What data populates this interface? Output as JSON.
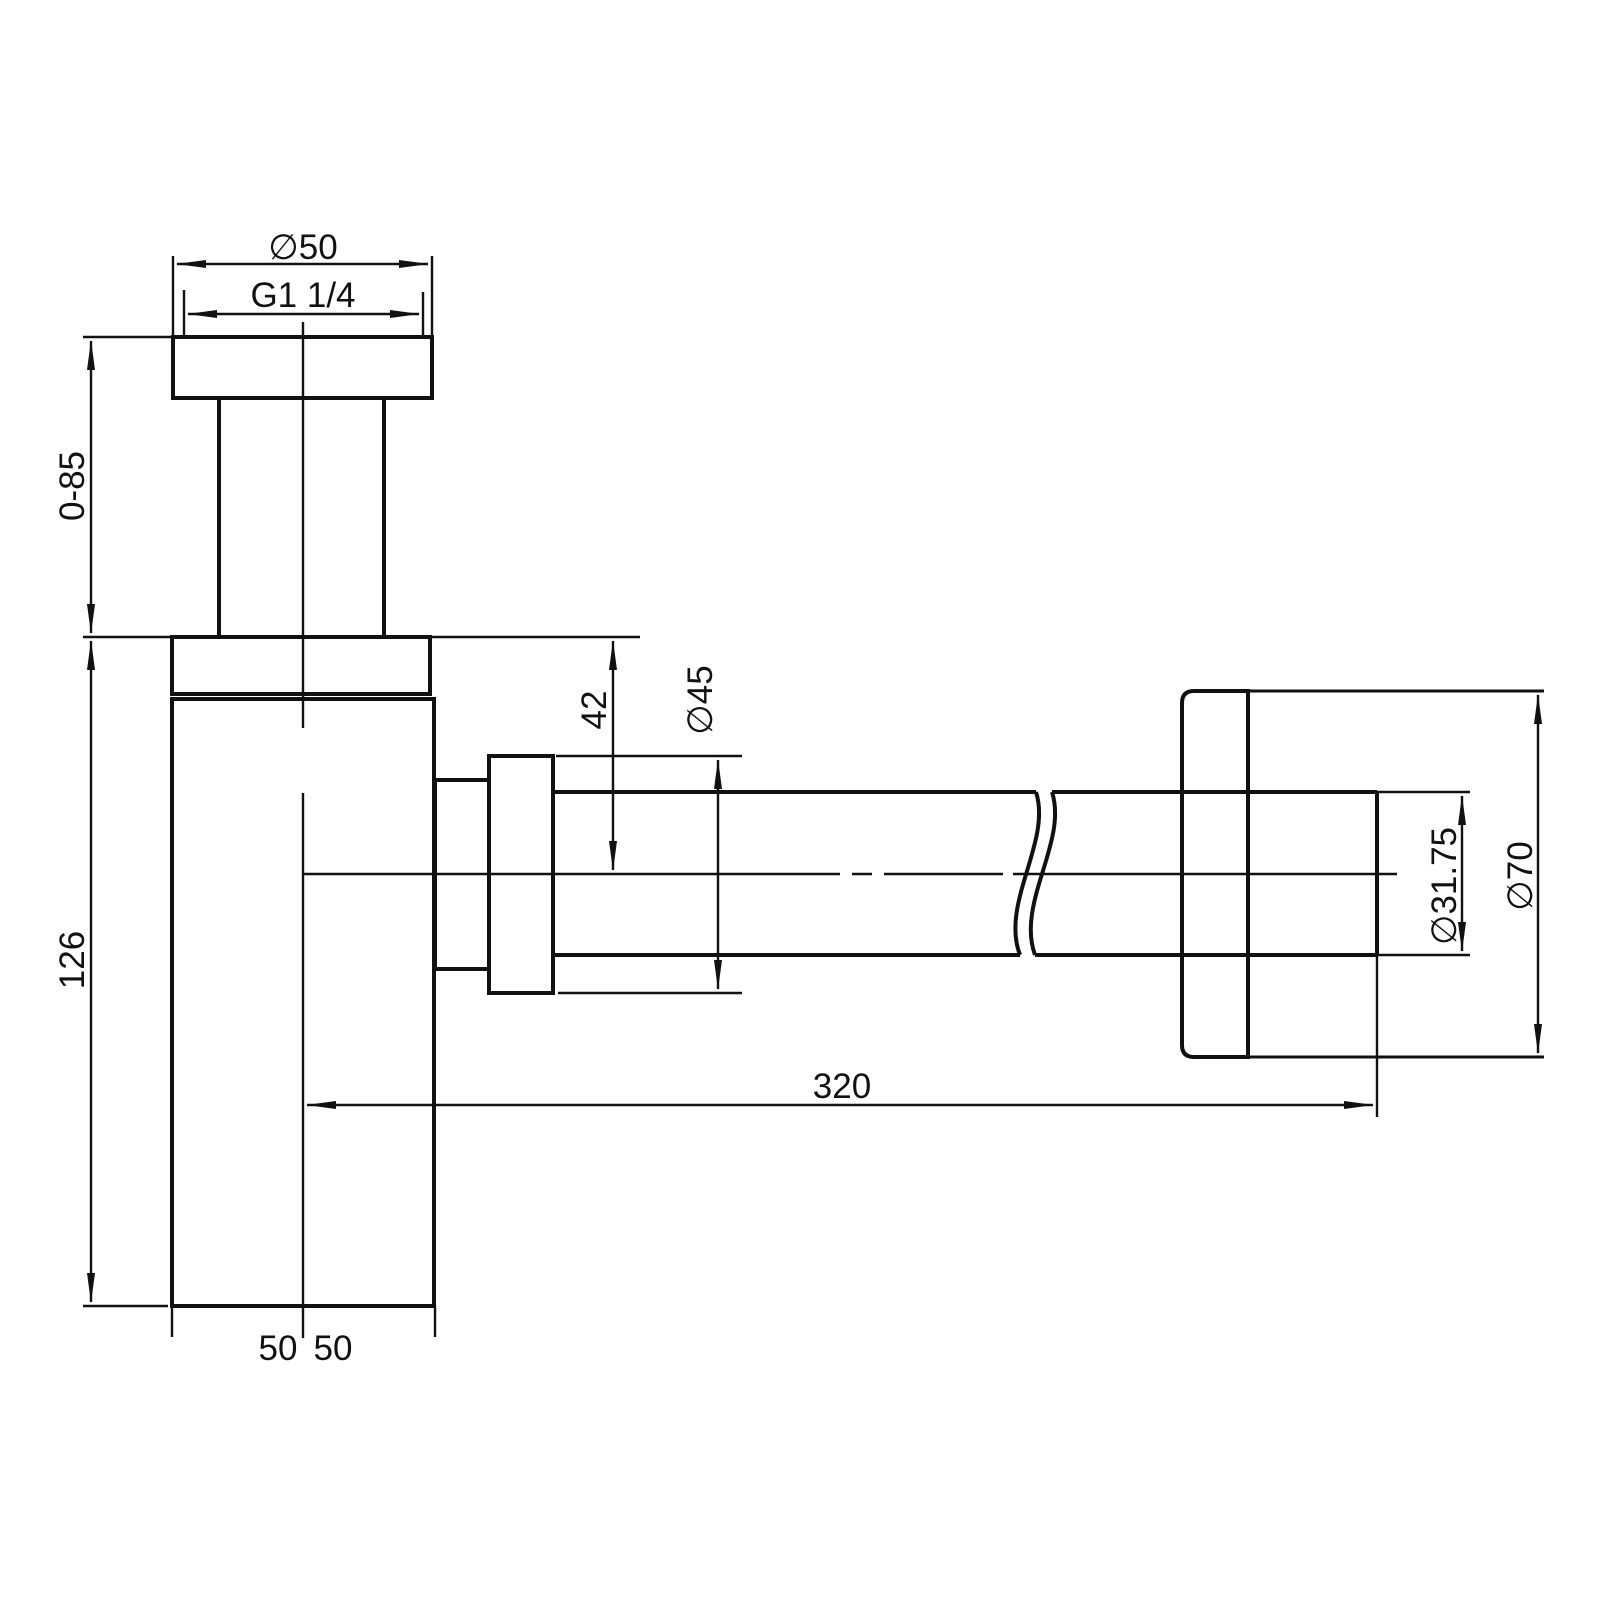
{
  "drawing": {
    "type": "technical-dimension-drawing",
    "subject": "bottle-trap-siphon-side-view",
    "colors": {
      "line": "#111111",
      "background": "#ffffff"
    },
    "labels": {
      "top_flange_diameter": "∅50",
      "thread_size": "G1 1/4",
      "adjustable_height": "0-85",
      "body_height": "126",
      "outlet_offset": "42",
      "nut_diameter": "∅45",
      "pipe_length": "320",
      "pipe_diameter": "∅31.75",
      "wall_flange_diameter": "∅70",
      "half_width_left": "50",
      "half_width_right": "50"
    }
  }
}
